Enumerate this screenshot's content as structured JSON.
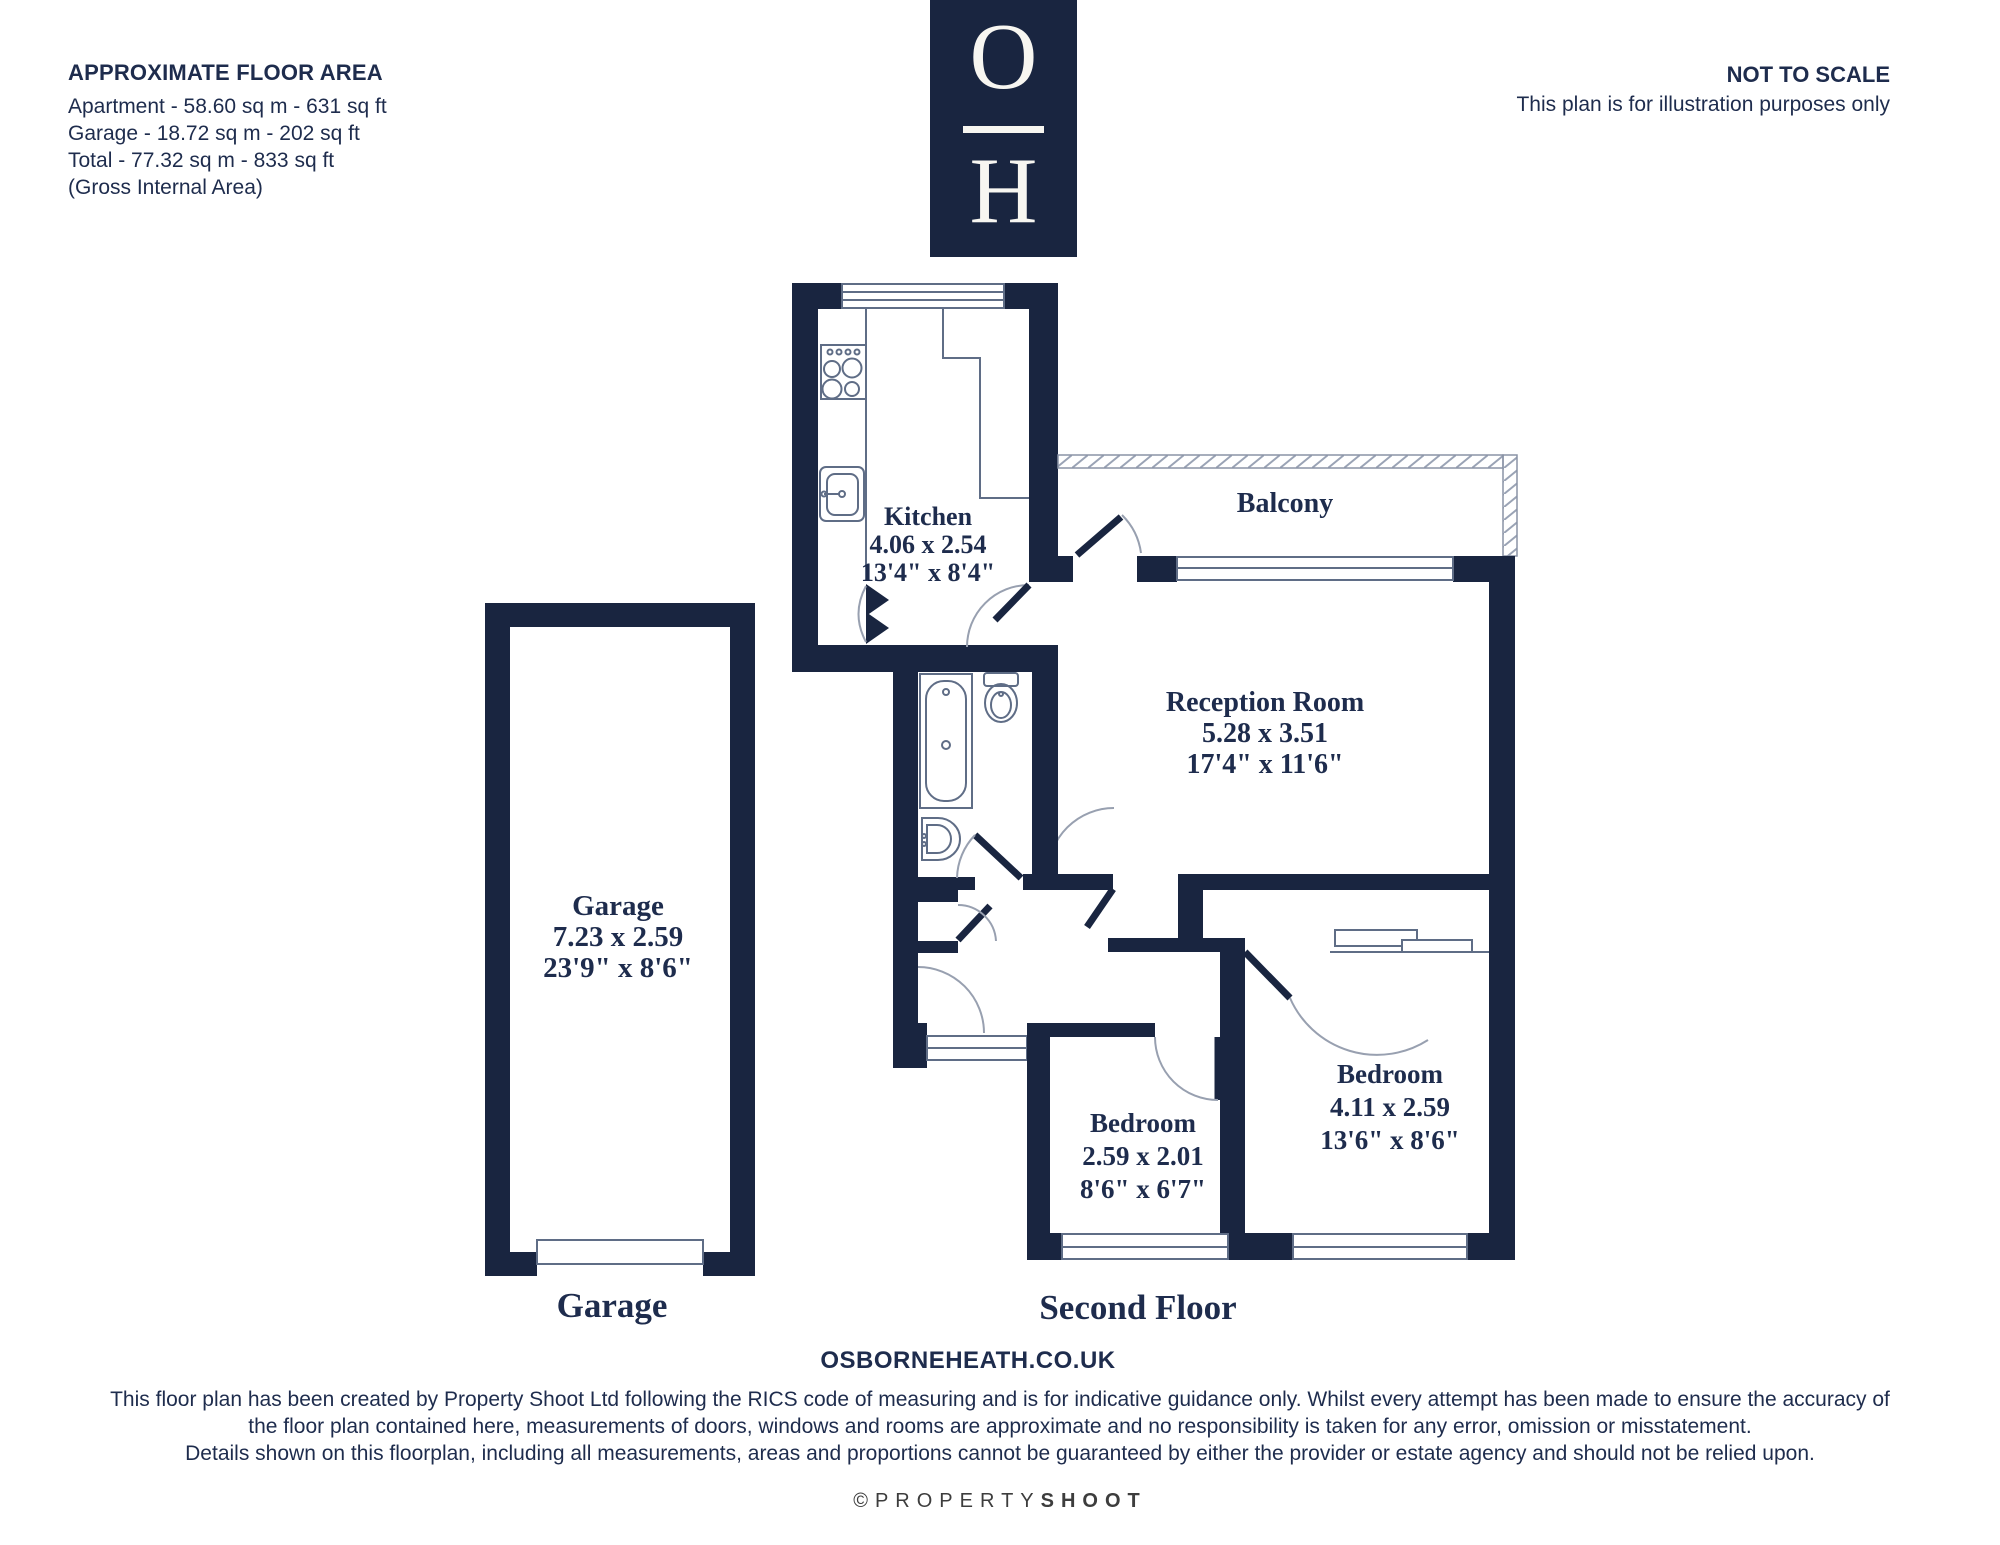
{
  "header": {
    "floor_area": {
      "title": "APPROXIMATE FLOOR AREA",
      "lines": [
        "Apartment - 58.60 sq m - 631 sq ft",
        "Garage - 18.72 sq m - 202 sq ft",
        "Total - 77.32 sq m - 833 sq ft",
        "(Gross Internal Area)"
      ]
    },
    "logo": {
      "top_letter": "O",
      "bottom_letter": "H"
    },
    "scale_note": {
      "title": "NOT TO SCALE",
      "subtitle": "This plan is for illustration purposes only"
    }
  },
  "plan": {
    "rooms": {
      "kitchen": {
        "name": "Kitchen",
        "metric": "4.06 x 2.54",
        "imperial": "13'4\" x 8'4\""
      },
      "balcony": {
        "name": "Balcony"
      },
      "reception": {
        "name": "Reception Room",
        "metric": "5.28 x 3.51",
        "imperial": "17'4\" x 11'6\""
      },
      "garage": {
        "name": "Garage",
        "metric": "7.23 x 2.59",
        "imperial": "23'9\" x 8'6\""
      },
      "bedroom_small": {
        "name": "Bedroom",
        "metric": "2.59 x 2.01",
        "imperial": "8'6\" x 6'7\""
      },
      "bedroom_large": {
        "name": "Bedroom",
        "metric": "4.11 x 2.59",
        "imperial": "13'6\" x 8'6\""
      }
    },
    "captions": {
      "garage": "Garage",
      "floor": "Second Floor"
    }
  },
  "footer": {
    "website": "OSBORNEHEATH.CO.UK",
    "disclaimer": [
      "This floor plan has been created by Property Shoot Ltd following the RICS code of measuring and is for indicative guidance only. Whilst every attempt has been made to ensure the accuracy of",
      "the floor plan contained here, measurements of doors, windows and rooms are approximate and no responsibility is taken for any error, omission or misstatement.",
      "Details shown on this floorplan, including all measurements, areas and proportions cannot be guaranteed by either the provider or estate agency and should not be relied upon."
    ],
    "credit_prefix": "©PROPERTY",
    "credit_suffix": "SHOOT"
  },
  "colors": {
    "wall": "#192540",
    "thin_line": "#5f6d86",
    "arc_line": "#98a0b0",
    "text": "#1e2c4d",
    "credit_text": "#3d3d3d"
  }
}
